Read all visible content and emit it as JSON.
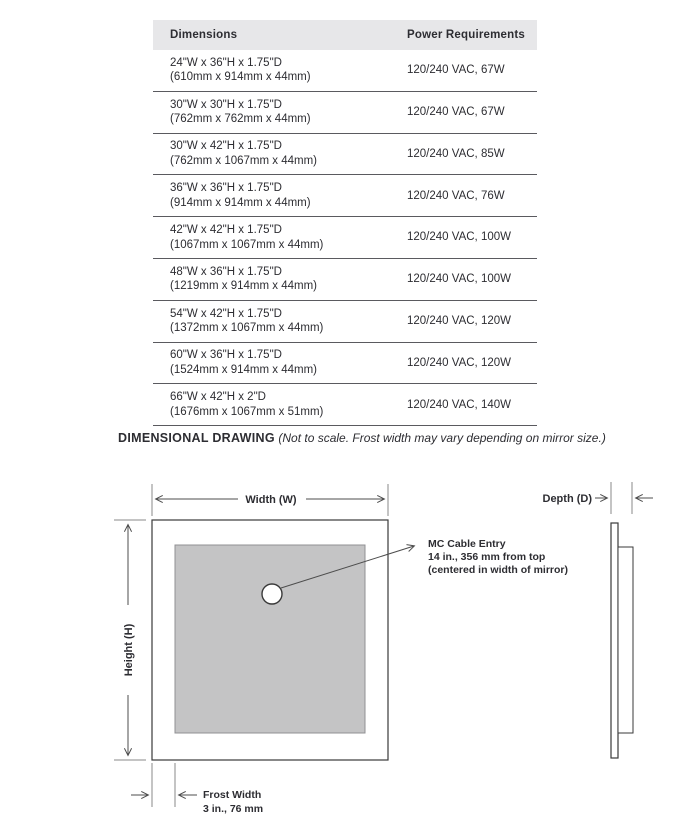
{
  "table": {
    "columns": {
      "dimensions": "Dimensions",
      "power": "Power Requirements"
    },
    "rows": [
      {
        "dims_in": "24\"W x 36\"H x 1.75\"D",
        "dims_mm": "(610mm x 914mm x 44mm)",
        "power": "120/240 VAC, 67W"
      },
      {
        "dims_in": "30\"W x 30\"H x 1.75\"D",
        "dims_mm": "(762mm x 762mm x 44mm)",
        "power": "120/240 VAC, 67W"
      },
      {
        "dims_in": "30\"W x 42\"H x 1.75\"D",
        "dims_mm": "(762mm x 1067mm x 44mm)",
        "power": "120/240 VAC, 85W"
      },
      {
        "dims_in": "36\"W x 36\"H x 1.75\"D",
        "dims_mm": "(914mm x 914mm x 44mm)",
        "power": "120/240 VAC, 76W"
      },
      {
        "dims_in": "42\"W x 42\"H x 1.75\"D",
        "dims_mm": "(1067mm x 1067mm x 44mm)",
        "power": "120/240 VAC, 100W"
      },
      {
        "dims_in": "48\"W x 36\"H x 1.75\"D",
        "dims_mm": "(1219mm x 914mm x 44mm)",
        "power": "120/240 VAC, 100W"
      },
      {
        "dims_in": "54\"W x 42\"H x 1.75\"D",
        "dims_mm": "(1372mm x 1067mm x 44mm)",
        "power": "120/240 VAC, 120W"
      },
      {
        "dims_in": "60\"W x 36\"H x 1.75\"D",
        "dims_mm": "(1524mm x 914mm x 44mm)",
        "power": "120/240 VAC, 120W"
      },
      {
        "dims_in": "66\"W x 42\"H x 2\"D",
        "dims_mm": "(1676mm x 1067mm x 51mm)",
        "power": "120/240 VAC, 140W"
      }
    ]
  },
  "drawing": {
    "title": "DIMENSIONAL DRAWING",
    "subtitle": "(Not to scale. Frost width may vary depending on mirror size.)",
    "width_label": "Width (W)",
    "height_label": "Height (H)",
    "depth_label": "Depth (D)",
    "cable_entry": {
      "line1": "MC Cable Entry",
      "line2": "14 in., 356 mm from top",
      "line3": "(centered in width of mirror)"
    },
    "frost_width": {
      "line1": "Frost Width",
      "line2": "3 in., 76 mm"
    }
  },
  "colors": {
    "header_bg": "#e7e7e9",
    "row_separator": "#5a5a5f",
    "text": "#2d2d32",
    "frost_fill": "#c4c4c5",
    "frost_stroke": "#909093",
    "outline": "#3a3a3a",
    "dim_line": "#4d4d4d",
    "extension_line": "#8a8a8a"
  }
}
